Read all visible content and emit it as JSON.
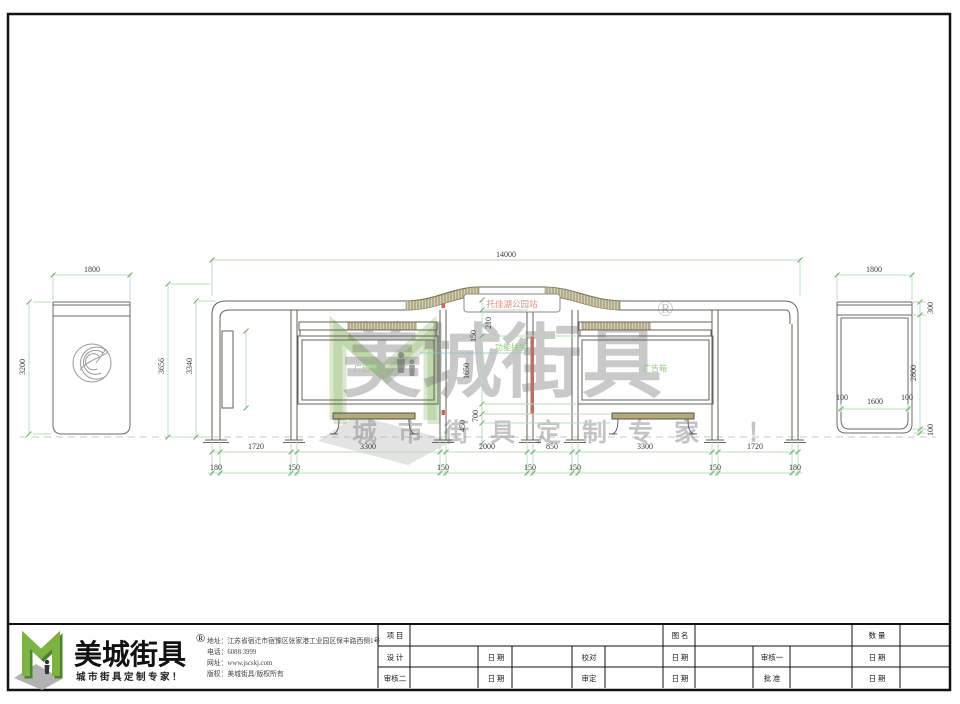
{
  "watermark": {
    "brand": "美城街具",
    "registered": "®",
    "tagline": "城市街具定制专家 ！"
  },
  "left_view": {
    "width": "1800",
    "height": "3200"
  },
  "main_view": {
    "total_width": "14000",
    "height_outer": "3656",
    "height_inner": "3340",
    "sign_text": "托佳湖公园站",
    "label_handrail": "功能扶手",
    "label_ad_left": "广告箱",
    "label_ad_right": "广告箱",
    "dim_roof": "210",
    "dim_band": "150",
    "dim_adbox": "1650",
    "dim_bench": "700",
    "dim_seat": "450",
    "bays": [
      "1720",
      "3300",
      "2000",
      "850",
      "3300",
      "1720"
    ],
    "posts": [
      "180",
      "150",
      "150",
      "150",
      "150",
      "150",
      "180"
    ]
  },
  "right_view": {
    "width": "1800",
    "top_height": "300",
    "body_height": "2800",
    "base_height": "100",
    "bottom_left": "100",
    "bottom_center": "1600",
    "bottom_right": "100"
  },
  "footer": {
    "brand": "美城街具",
    "registered": "®",
    "tagline": "城市街具定制专家！",
    "address": "地址：江苏省宿迁市宿豫区张家港工业园区保丰路西侧1号",
    "phone": "电话：6088 3999",
    "website": "网址：www.jscskj.com",
    "copyright": "版权：美城街具/版权所有"
  },
  "titleblock": {
    "project": "项 目",
    "drawing_name": "图 名",
    "quantity": "数 量",
    "designer": "设 计",
    "date": "日 期",
    "proofread": "校对",
    "reviewer1": "审核一",
    "reviewer2": "审核二",
    "approver": "审定",
    "ratifier": "批 准"
  }
}
